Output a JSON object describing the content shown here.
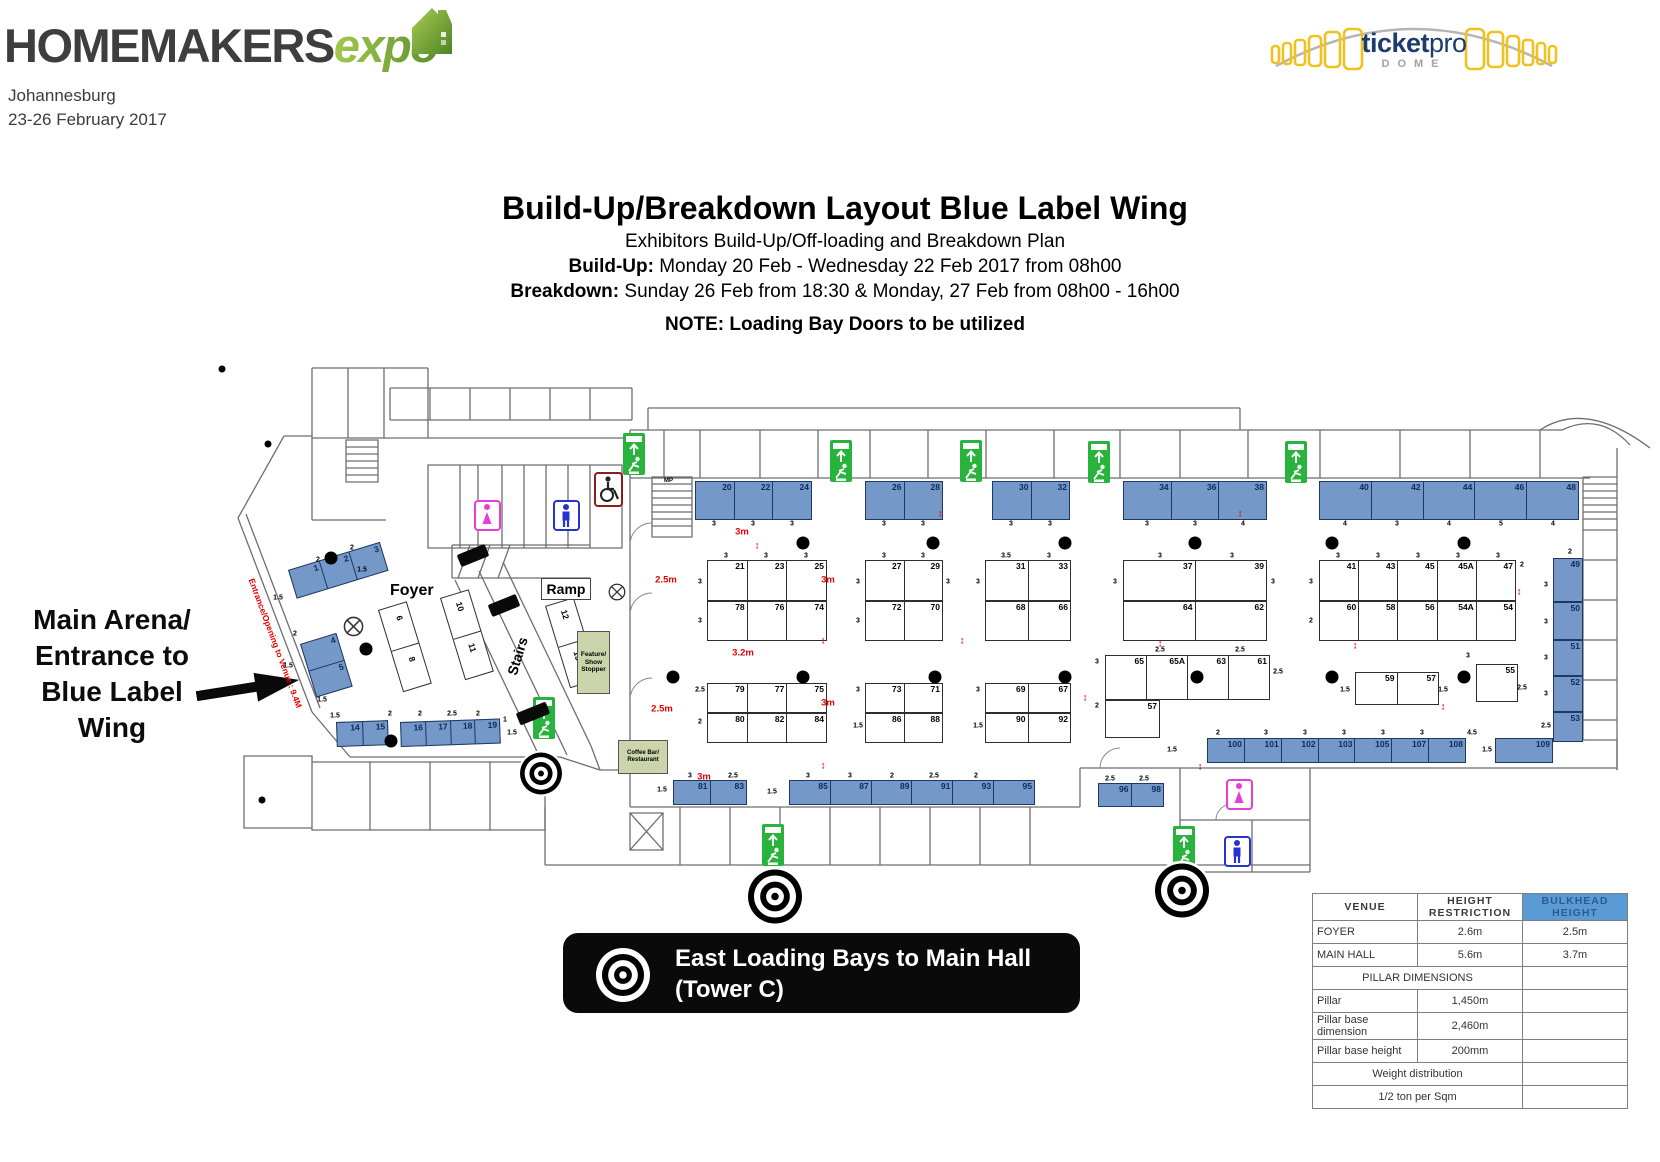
{
  "header": {
    "logo_main": "HOMEMAKERS",
    "logo_accent": "expo",
    "city": "Johannesburg",
    "dates": "23-26 February 2017",
    "venue_logo": {
      "ticket": "ticket",
      "pro": "pro",
      "dome": "DOME"
    }
  },
  "title_block": {
    "title": "Build-Up/Breakdown Layout Blue Label Wing",
    "subtitle": "Exhibitors Build-Up/Off-loading and Breakdown Plan",
    "buildup_label": "Build-Up:",
    "buildup_text": " Monday 20 Feb - Wednesday 22 Feb 2017 from 08h00",
    "breakdown_label": "Breakdown:",
    "breakdown_text": " Sunday 26 Feb from 18:30 & Monday, 27 Feb from 08h00 - 16h00",
    "note": "NOTE: Loading Bay Doors to be utilized"
  },
  "entrance_label": {
    "text": "Main Arena/\nEntrance to\nBlue Label\nWing"
  },
  "banner": {
    "line1": "East Loading Bays to Main Hall",
    "line2": "(Tower C)"
  },
  "colors": {
    "booth_blue": "#7498c7",
    "exit_green": "#28b43c",
    "table_header_blue": "#5b9bd5",
    "accent_green": "#7cab35",
    "red": "#e70000"
  },
  "floorplan": {
    "entrance_text": {
      "t": "Entrance/Opening to Venue : 9.4M",
      "x": 256,
      "y": 577,
      "rot": 69.5
    },
    "booth_groups": [
      {
        "x": 695,
        "y": 481,
        "w": 117,
        "h": 39,
        "t": "b",
        "cells": [
          "20",
          "22",
          "24"
        ]
      },
      {
        "x": 865,
        "y": 481,
        "w": 78,
        "h": 39,
        "t": "b",
        "cells": [
          "26",
          "28"
        ]
      },
      {
        "x": 992,
        "y": 481,
        "w": 78,
        "h": 39,
        "t": "b",
        "cells": [
          "30",
          "32"
        ]
      },
      {
        "x": 1123,
        "y": 481,
        "w": 144,
        "h": 39,
        "t": "b",
        "cells": [
          "34",
          "36",
          "38"
        ]
      },
      {
        "x": 1319,
        "y": 481,
        "w": 260,
        "h": 39,
        "t": "b",
        "cells": [
          "40",
          "42",
          "44",
          "46",
          "48"
        ]
      },
      {
        "x": 707,
        "y": 560,
        "w": 120,
        "h": 41,
        "t": "w",
        "cells": [
          "21",
          "23",
          "25"
        ]
      },
      {
        "x": 707,
        "y": 601,
        "w": 120,
        "h": 40,
        "t": "w",
        "cells": [
          "78",
          "76",
          "74"
        ]
      },
      {
        "x": 865,
        "y": 560,
        "w": 78,
        "h": 41,
        "t": "w",
        "cells": [
          "27",
          "29"
        ]
      },
      {
        "x": 865,
        "y": 601,
        "w": 78,
        "h": 40,
        "t": "w",
        "cells": [
          "72",
          "70"
        ]
      },
      {
        "x": 985,
        "y": 560,
        "w": 86,
        "h": 41,
        "t": "w",
        "cells": [
          "31",
          "33"
        ]
      },
      {
        "x": 985,
        "y": 601,
        "w": 86,
        "h": 40,
        "t": "w",
        "cells": [
          "68",
          "66"
        ]
      },
      {
        "x": 1123,
        "y": 560,
        "w": 144,
        "h": 41,
        "t": "w",
        "cells": [
          "37",
          "39"
        ]
      },
      {
        "x": 1123,
        "y": 601,
        "w": 144,
        "h": 40,
        "t": "w",
        "cells": [
          "64",
          "62"
        ]
      },
      {
        "x": 1319,
        "y": 560,
        "w": 197,
        "h": 41,
        "t": "w",
        "cells": [
          "41",
          "43",
          "45",
          "45A",
          "47"
        ]
      },
      {
        "x": 1319,
        "y": 601,
        "w": 197,
        "h": 40,
        "t": "w",
        "cells": [
          "60",
          "58",
          "56",
          "54A",
          "54"
        ]
      },
      {
        "x": 707,
        "y": 683,
        "w": 120,
        "h": 30,
        "t": "w",
        "cells": [
          "79",
          "77",
          "75"
        ]
      },
      {
        "x": 707,
        "y": 713,
        "w": 120,
        "h": 30,
        "t": "w",
        "cells": [
          "80",
          "82",
          "84"
        ]
      },
      {
        "x": 865,
        "y": 683,
        "w": 78,
        "h": 30,
        "t": "w",
        "cells": [
          "73",
          "71"
        ]
      },
      {
        "x": 865,
        "y": 713,
        "w": 78,
        "h": 30,
        "t": "w",
        "cells": [
          "86",
          "88"
        ]
      },
      {
        "x": 985,
        "y": 683,
        "w": 86,
        "h": 30,
        "t": "w",
        "cells": [
          "69",
          "67"
        ]
      },
      {
        "x": 985,
        "y": 713,
        "w": 86,
        "h": 30,
        "t": "w",
        "cells": [
          "90",
          "92"
        ]
      },
      {
        "x": 1105,
        "y": 655,
        "w": 165,
        "h": 45,
        "t": "w",
        "cells": [
          "65",
          "65A",
          "63",
          "61"
        ]
      },
      {
        "x": 1105,
        "y": 700,
        "w": 55,
        "h": 38,
        "t": "w",
        "cells": [
          "57"
        ]
      },
      {
        "x": 1355,
        "y": 672,
        "w": 84,
        "h": 33,
        "t": "w",
        "cells": [
          "59",
          "57"
        ]
      },
      {
        "x": 1476,
        "y": 664,
        "w": 42,
        "h": 38,
        "t": "w",
        "cells": [
          "55"
        ]
      },
      {
        "x": 673,
        "y": 780,
        "w": 74,
        "h": 25,
        "t": "b",
        "cells": [
          "81",
          "83"
        ]
      },
      {
        "x": 789,
        "y": 780,
        "w": 246,
        "h": 25,
        "t": "b",
        "cells": [
          "85",
          "87",
          "89",
          "91",
          "93",
          "95"
        ]
      },
      {
        "x": 1098,
        "y": 783,
        "w": 66,
        "h": 24,
        "t": "b",
        "cells": [
          "96",
          "98"
        ]
      },
      {
        "x": 1207,
        "y": 738,
        "w": 259,
        "h": 25,
        "t": "b",
        "cells": [
          "100",
          "101",
          "102",
          "103",
          "105",
          "107",
          "108"
        ]
      },
      {
        "x": 1495,
        "y": 738,
        "w": 58,
        "h": 25,
        "t": "b",
        "cells": [
          "109"
        ]
      },
      {
        "x": 1553,
        "y": 558,
        "w": 30,
        "h": 44,
        "t": "b",
        "cells": [
          "49"
        ]
      },
      {
        "x": 1553,
        "y": 602,
        "w": 30,
        "h": 38,
        "t": "b",
        "cells": [
          "50"
        ]
      },
      {
        "x": 1553,
        "y": 640,
        "w": 30,
        "h": 36,
        "t": "b",
        "cells": [
          "51"
        ]
      },
      {
        "x": 1553,
        "y": 676,
        "w": 30,
        "h": 36,
        "t": "b",
        "cells": [
          "52"
        ]
      },
      {
        "x": 1553,
        "y": 712,
        "w": 30,
        "h": 30,
        "t": "b",
        "cells": [
          "53"
        ]
      },
      {
        "x": 288,
        "y": 570,
        "w": 96,
        "h": 30,
        "t": "b",
        "rot": -17,
        "cells": [
          "1",
          "2",
          "3"
        ]
      },
      {
        "x": 300,
        "y": 644,
        "w": 38,
        "h": 56,
        "t": "b",
        "rot": -17,
        "stack": true,
        "cells": [
          "4",
          "5"
        ]
      },
      {
        "x": 378,
        "y": 610,
        "w": 30,
        "h": 86,
        "t": "w",
        "rot": -17,
        "stack": true,
        "cells": [
          "6",
          "8"
        ]
      },
      {
        "x": 440,
        "y": 598,
        "w": 30,
        "h": 86,
        "t": "w",
        "rot": -17,
        "stack": true,
        "cells": [
          "10",
          "11"
        ]
      },
      {
        "x": 545,
        "y": 606,
        "w": 30,
        "h": 86,
        "t": "w",
        "rot": -17,
        "stack": true,
        "cells": [
          "12",
          "13"
        ]
      },
      {
        "x": 336,
        "y": 722,
        "w": 52,
        "h": 25,
        "t": "b",
        "rot": -2,
        "cells": [
          "14",
          "15"
        ]
      },
      {
        "x": 400,
        "y": 722,
        "w": 100,
        "h": 25,
        "t": "b",
        "rot": -2,
        "cells": [
          "16",
          "17",
          "18",
          "19"
        ]
      }
    ],
    "pillars": [
      [
        803,
        543
      ],
      [
        933,
        543
      ],
      [
        1065,
        543
      ],
      [
        1195,
        543
      ],
      [
        1332,
        543
      ],
      [
        1464,
        543
      ],
      [
        673,
        677
      ],
      [
        803,
        677
      ],
      [
        935,
        677
      ],
      [
        1065,
        677
      ],
      [
        1197,
        677
      ],
      [
        1332,
        677
      ],
      [
        1464,
        677
      ],
      [
        331,
        558
      ],
      [
        366,
        649
      ],
      [
        391,
        741
      ]
    ],
    "outside_dots": [
      [
        222,
        369
      ],
      [
        268,
        444
      ],
      [
        262,
        800
      ]
    ],
    "exits": [
      [
        623,
        433
      ],
      [
        830,
        440
      ],
      [
        960,
        440
      ],
      [
        1088,
        441
      ],
      [
        1285,
        441
      ],
      [
        533,
        697
      ],
      [
        762,
        824
      ],
      [
        1173,
        826
      ]
    ],
    "toilets": [
      {
        "x": 474,
        "y": 500,
        "g": "f"
      },
      {
        "x": 553,
        "y": 500,
        "g": "m"
      },
      {
        "x": 1226,
        "y": 779,
        "g": "f"
      },
      {
        "x": 1224,
        "y": 836,
        "g": "m"
      }
    ],
    "wheelchair": {
      "x": 594,
      "y": 472
    },
    "targets": [
      {
        "x": 541,
        "y": 776,
        "r": 21
      },
      {
        "x": 775,
        "y": 899,
        "r": 27
      },
      {
        "x": 1182,
        "y": 893,
        "r": 27
      }
    ],
    "symbols": [
      {
        "x": 343,
        "y": 616,
        "d": 21
      },
      {
        "x": 608,
        "y": 583,
        "d": 18
      }
    ],
    "bars": [
      {
        "x": 458,
        "y": 549,
        "w": 30,
        "h": 13,
        "rot": -22
      },
      {
        "x": 489,
        "y": 599,
        "w": 30,
        "h": 13,
        "rot": -22
      },
      {
        "x": 517,
        "y": 707,
        "w": 32,
        "h": 13,
        "rot": -22
      }
    ],
    "labels": [
      {
        "t": "Foyer",
        "x": 390,
        "y": 582,
        "fs": 16,
        "kind": "plain"
      },
      {
        "t": "Ramp",
        "x": 541,
        "y": 578,
        "fs": 14,
        "kind": "boxed",
        "w": 50,
        "h": 22
      },
      {
        "t": "Stairs",
        "x": 498,
        "y": 648,
        "fs": 14,
        "kind": "plain",
        "rot": -73
      },
      {
        "t": "Feature/\nShow\nStopper",
        "x": 577,
        "y": 631,
        "fs": 6.5,
        "kind": "green",
        "w": 33,
        "h": 63
      },
      {
        "t": "Coffee Bar/\nRestaurant",
        "x": 618,
        "y": 740,
        "fs": 6,
        "kind": "green",
        "w": 50,
        "h": 34
      },
      {
        "t": "MP",
        "x": 664,
        "y": 478,
        "fs": 6,
        "kind": "plain"
      }
    ],
    "dims_red": [
      [
        742,
        532,
        "3m"
      ],
      [
        666,
        580,
        "2.5m"
      ],
      [
        828,
        580,
        "3m"
      ],
      [
        743,
        653,
        "3.2m"
      ],
      [
        662,
        709,
        "2.5m"
      ],
      [
        828,
        703,
        "3m"
      ],
      [
        704,
        777,
        "3m"
      ]
    ],
    "red_arrows": [
      [
        757,
        546
      ],
      [
        823,
        641
      ],
      [
        962,
        641
      ],
      [
        1160,
        644
      ],
      [
        1355,
        646
      ],
      [
        823,
        766
      ],
      [
        1085,
        698
      ],
      [
        1200,
        767
      ],
      [
        1443,
        707
      ],
      [
        940,
        514
      ],
      [
        1240,
        514
      ],
      [
        1519,
        592
      ]
    ],
    "dims_small": [
      [
        714,
        524,
        "3"
      ],
      [
        753,
        524,
        "3"
      ],
      [
        792,
        524,
        "3"
      ],
      [
        884,
        524,
        "3"
      ],
      [
        923,
        524,
        "3"
      ],
      [
        1011,
        524,
        "3"
      ],
      [
        1050,
        524,
        "3"
      ],
      [
        1147,
        524,
        "3"
      ],
      [
        1195,
        524,
        "3"
      ],
      [
        1243,
        524,
        "4"
      ],
      [
        1345,
        524,
        "4"
      ],
      [
        1397,
        524,
        "3"
      ],
      [
        1449,
        524,
        "4"
      ],
      [
        1501,
        524,
        "5"
      ],
      [
        1553,
        524,
        "4"
      ],
      [
        726,
        556,
        "3"
      ],
      [
        766,
        556,
        "3"
      ],
      [
        806,
        556,
        "3"
      ],
      [
        884,
        556,
        "3"
      ],
      [
        923,
        556,
        "3"
      ],
      [
        1006,
        556,
        "3.5"
      ],
      [
        1049,
        556,
        "3"
      ],
      [
        1160,
        556,
        "3"
      ],
      [
        1232,
        556,
        "3"
      ],
      [
        1338,
        556,
        "3"
      ],
      [
        1378,
        556,
        "3"
      ],
      [
        1418,
        556,
        "3"
      ],
      [
        1458,
        556,
        "3"
      ],
      [
        1498,
        556,
        "3"
      ],
      [
        700,
        582,
        "3"
      ],
      [
        700,
        621,
        "3"
      ],
      [
        858,
        582,
        "3"
      ],
      [
        858,
        621,
        "3"
      ],
      [
        948,
        582,
        "3"
      ],
      [
        978,
        582,
        "3"
      ],
      [
        1115,
        582,
        "3"
      ],
      [
        1273,
        582,
        "3"
      ],
      [
        1311,
        582,
        "3"
      ],
      [
        1311,
        621,
        "2"
      ],
      [
        1522,
        565,
        "2"
      ],
      [
        700,
        690,
        "2.5"
      ],
      [
        700,
        722,
        "2"
      ],
      [
        858,
        690,
        "3"
      ],
      [
        858,
        726,
        "1.5"
      ],
      [
        978,
        690,
        "3"
      ],
      [
        978,
        726,
        "1.5"
      ],
      [
        1097,
        662,
        "3"
      ],
      [
        1097,
        706,
        "2"
      ],
      [
        1160,
        650,
        "2.5"
      ],
      [
        1240,
        650,
        "2.5"
      ],
      [
        1278,
        672,
        "2.5"
      ],
      [
        1345,
        690,
        "1.5"
      ],
      [
        1443,
        690,
        "1.5"
      ],
      [
        1468,
        656,
        "3"
      ],
      [
        1522,
        688,
        "2.5"
      ],
      [
        690,
        776,
        "3"
      ],
      [
        733,
        776,
        "2.5"
      ],
      [
        808,
        776,
        "3"
      ],
      [
        850,
        776,
        "3"
      ],
      [
        892,
        776,
        "2"
      ],
      [
        934,
        776,
        "2.5"
      ],
      [
        976,
        776,
        "2"
      ],
      [
        1110,
        779,
        "2.5"
      ],
      [
        1144,
        779,
        "2.5"
      ],
      [
        662,
        790,
        "1.5"
      ],
      [
        772,
        792,
        "1.5"
      ],
      [
        1218,
        733,
        "2"
      ],
      [
        1266,
        733,
        "3"
      ],
      [
        1305,
        733,
        "3"
      ],
      [
        1344,
        733,
        "3"
      ],
      [
        1383,
        733,
        "3"
      ],
      [
        1422,
        733,
        "3"
      ],
      [
        1472,
        733,
        "4.5"
      ],
      [
        1487,
        750,
        "1.5"
      ],
      [
        1172,
        750,
        "1.5"
      ],
      [
        1570,
        552,
        "2"
      ],
      [
        1546,
        585,
        "3"
      ],
      [
        1546,
        622,
        "3"
      ],
      [
        1546,
        658,
        "3"
      ],
      [
        1546,
        694,
        "3"
      ],
      [
        1546,
        726,
        "2.5"
      ],
      [
        278,
        598,
        "1.5"
      ],
      [
        318,
        560,
        "2"
      ],
      [
        352,
        548,
        "2"
      ],
      [
        295,
        634,
        "2"
      ],
      [
        288,
        666,
        "1.5"
      ],
      [
        322,
        700,
        "1.5"
      ],
      [
        335,
        716,
        "1.5"
      ],
      [
        390,
        714,
        "2"
      ],
      [
        420,
        714,
        "2"
      ],
      [
        452,
        714,
        "2.5"
      ],
      [
        478,
        714,
        "2"
      ],
      [
        505,
        720,
        "1"
      ],
      [
        512,
        733,
        "1.5"
      ],
      [
        362,
        570,
        "1.5"
      ]
    ]
  },
  "spec_table": {
    "col_headers": [
      "VENUE",
      "HEIGHT RESTRICTION",
      "BULKHEAD HEIGHT"
    ],
    "rows": [
      {
        "cells": [
          "FOYER",
          "2.6m",
          "2.5m"
        ]
      },
      {
        "cells": [
          "MAIN HALL",
          "5.6m",
          "3.7m"
        ]
      },
      {
        "span": "PILLAR DIMENSIONS"
      },
      {
        "cells": [
          "Pillar",
          "1,450m",
          ""
        ]
      },
      {
        "cells": [
          "Pillar base dimension",
          "2,460m",
          ""
        ]
      },
      {
        "cells": [
          "Pillar base height",
          "200mm",
          ""
        ]
      },
      {
        "span": "Weight distribution"
      },
      {
        "span": "1/2 ton per Sqm"
      }
    ]
  }
}
